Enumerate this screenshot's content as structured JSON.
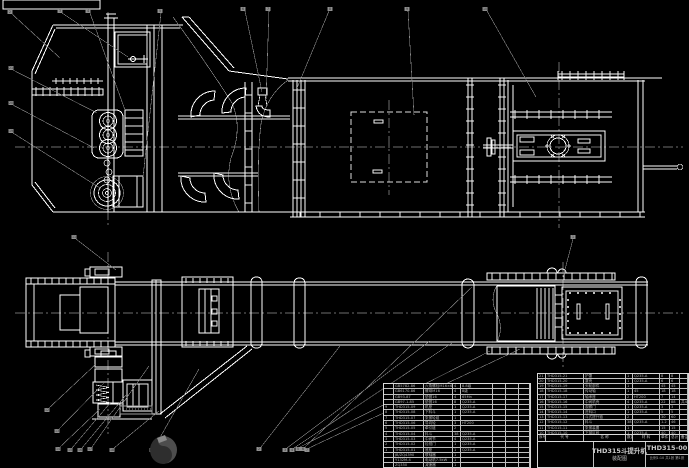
{
  "colors": {
    "background": "#000000",
    "line": "#ffffff",
    "leader": "#8a8a8a",
    "table_text": "#b4b4b4"
  },
  "title_block": {
    "title": "THD315斗提升机",
    "subtitle": "装配图",
    "drawing_number": "THD315-00",
    "info_line": "比例1:10 共1张 第1张",
    "signature_cells": [
      "设计",
      "",
      "",
      "制图",
      "",
      "",
      "审核",
      "",
      ""
    ]
  },
  "parts_table_right": {
    "header": [
      "序号",
      "代 号",
      "名 称",
      "数量",
      "材 料",
      "单件",
      "总计",
      "备注"
    ],
    "rows": [
      [
        "21",
        "THD315-21",
        "护罩",
        "1",
        "Q235-A",
        "8",
        "8",
        ""
      ],
      [
        "20",
        "THD315-20",
        "罩壳",
        "1",
        "Q235-A",
        "6",
        "6",
        ""
      ],
      [
        "19",
        "THD315-19",
        "头轮部件",
        "1",
        "",
        "45",
        "45",
        ""
      ],
      [
        "18",
        "THD315-18",
        "传动轴",
        "1",
        "45",
        "18",
        "18",
        ""
      ],
      [
        "17",
        "THD315-17",
        "轴承座",
        "2",
        "HT200",
        "7",
        "14",
        ""
      ],
      [
        "16",
        "THD315-16",
        "中间机壳",
        "4",
        "Q235-A",
        "22",
        "88",
        "共4节"
      ],
      [
        "15",
        "THD315-15",
        "观察门",
        "1",
        "Q235-A",
        "3",
        "3",
        ""
      ],
      [
        "14",
        "THD315-14",
        "进料口",
        "1",
        "Q235-A",
        "5",
        "5",
        ""
      ],
      [
        "13",
        "THD315-13",
        "斗式提升链",
        "2",
        "",
        "30",
        "60",
        ""
      ],
      [
        "12",
        "THD315-12",
        "料斗",
        "38",
        "Q235-A",
        "1.2",
        "46",
        ""
      ],
      [
        "11",
        "THD315-11",
        "张紧装置",
        "1",
        "",
        "15",
        "15",
        ""
      ],
      [
        "10",
        "THD315-10",
        "下部区段",
        "1",
        "Q235-A",
        "40",
        "40",
        ""
      ]
    ]
  },
  "parts_table_left": {
    "rows": [
      [
        "",
        "GB5782-86",
        "六角螺栓M16×60",
        "4",
        "8.8级",
        "",
        "",
        ""
      ],
      [
        "",
        "GB6170-86",
        "螺母M16",
        "4",
        "8级",
        "",
        "",
        ""
      ],
      [
        "",
        "GB93-87",
        "垫圈16",
        "4",
        "65Mn",
        "",
        "",
        ""
      ],
      [
        "",
        "GB97.1-85",
        "垫圈16",
        "8",
        "Q235-A",
        "",
        "",
        ""
      ],
      [
        "9",
        "THD315-09",
        "机座",
        "1",
        "Q235-A",
        "",
        "",
        ""
      ],
      [
        "8",
        "THD315-08",
        "下料斗",
        "1",
        "Q235-A",
        "",
        "",
        ""
      ],
      [
        "7",
        "THD315-07",
        "张紧轮组",
        "1",
        "",
        "",
        "",
        ""
      ],
      [
        "6",
        "THD315-06",
        "导向轮",
        "3",
        "HT200",
        "",
        "",
        ""
      ],
      [
        "5",
        "THD315-05",
        "牵引链",
        "2",
        "",
        "",
        "",
        ""
      ],
      [
        "4",
        "THD315-04",
        "料斗",
        "38",
        "Q235-A",
        "",
        "",
        ""
      ],
      [
        "3",
        "THD315-03",
        "中间节",
        "4",
        "Q235-A",
        "",
        "",
        ""
      ],
      [
        "2",
        "THD315-02",
        "检视门",
        "1",
        "Q235-A",
        "",
        "",
        ""
      ],
      [
        "1",
        "THD315-01",
        "底座",
        "1",
        "Q235-A",
        "",
        "",
        ""
      ],
      [
        "",
        "JB/ZQ4390",
        "联轴器",
        "1",
        "",
        "",
        "",
        ""
      ],
      [
        "",
        "Y132M-4",
        "电动机7.5kW",
        "1",
        "",
        "",
        "",
        ""
      ],
      [
        "",
        "ZQ350",
        "减速器",
        "1",
        "",
        "",
        "",
        ""
      ]
    ]
  },
  "balloons": [
    {
      "n": "2"
    },
    {
      "n": "3"
    },
    {
      "n": "4"
    },
    {
      "n": "5"
    },
    {
      "n": "6"
    },
    {
      "n": "7"
    },
    {
      "n": "8"
    },
    {
      "n": "9"
    },
    {
      "n": "10"
    },
    {
      "n": "1"
    },
    {
      "n": "21"
    },
    {
      "n": "20"
    },
    {
      "n": "19"
    },
    {
      "n": "11"
    },
    {
      "n": "12"
    },
    {
      "n": "13"
    },
    {
      "n": "14"
    },
    {
      "n": "15"
    },
    {
      "n": "16"
    },
    {
      "n": "17"
    },
    {
      "n": "18"
    },
    {
      "n": "19"
    },
    {
      "n": "2"
    },
    {
      "n": "3"
    },
    {
      "n": "4"
    },
    {
      "n": "5"
    },
    {
      "n": "6"
    },
    {
      "n": "7"
    }
  ]
}
